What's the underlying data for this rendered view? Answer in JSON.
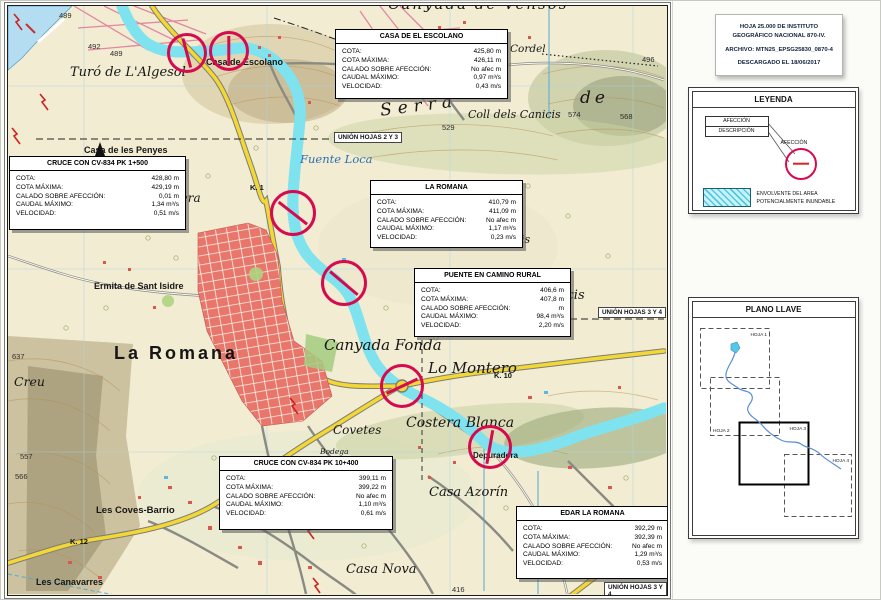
{
  "map": {
    "box_fields": [
      "COTA:",
      "COTA MÁXIMA:",
      "CALADO SOBRE AFECCIÓN:",
      "CAUDAL MÁXIMO:",
      "VELOCIDAD:"
    ],
    "boxes": [
      {
        "title": "CASA DE EL ESCOLANO",
        "values": [
          "425,80 m",
          "426,11 m",
          "No afec m",
          "0,97 m³/s",
          "0,43 m/s"
        ]
      },
      {
        "title": "CRUCE CON CV-834 PK 1+500",
        "values": [
          "428,80 m",
          "429,19 m",
          "0,01 m",
          "1,34 m³/s",
          "0,51 m/s"
        ]
      },
      {
        "title": "LA ROMANA",
        "values": [
          "410,79 m",
          "411,09 m",
          "No afec m",
          "1,17 m³/s",
          "0,23 m/s"
        ]
      },
      {
        "title": "PUENTE EN CAMINO RURAL",
        "values": [
          "406,6 m",
          "407,8 m",
          "m",
          "98,4 m³/s",
          "2,20 m/s"
        ]
      },
      {
        "title": "CRUCE CON CV-834 PK 10+400",
        "values": [
          "399,11 m",
          "399,22 m",
          "No afec m",
          "1,10 m³/s",
          "0,61 m/s"
        ]
      },
      {
        "title": "EDAR LA ROMANA",
        "values": [
          "392,29 m",
          "392,39 m",
          "No afec m",
          "1,29 m³/s",
          "0,53 m/s"
        ]
      }
    ],
    "places": {
      "canyada_vensos": "Canyada de Vensos",
      "turo_algesol": "Turó de L'Algesol",
      "casa_escolano": "Casa de Escolano",
      "a_romana": "a Romana",
      "cordel": "Cordel",
      "serra": "Serra",
      "de": "de",
      "coll_canicis": "Coll  dels  Canicis",
      "fuente_loca": "Fuente Loca",
      "casa_penyes": "Casa de les Penyes",
      "la_teulera": "La Teulera",
      "ermita": "Ermita de Sant  Isidre",
      "la_romana": "La Romana",
      "creu": "Creu",
      "canyada_fonda": "Canyada Fonda",
      "lo_montero": "Lo Montero",
      "costera_blanca": "Costera Blanca",
      "covetes": "Covetes",
      "bodega": "Bodega",
      "casa_azorin": "Casa Azorín",
      "casa_nova": "Casa Nova",
      "les_coves": "Les Coves-Barrio",
      "canavarres": "Les Canavarres",
      "depuradora": "Depuradora",
      "dels_canicis": "dels Canicis",
      "nicis": "nicis"
    },
    "elevations": {
      "a489": "489",
      "a492": "492",
      "b489": "489",
      "a496": "496",
      "a568": "568",
      "a574": "574",
      "a529": "529",
      "a459": "459",
      "a637": "637",
      "a557": "557",
      "a566": "566",
      "a416": "416"
    },
    "km": {
      "k1": "K. 1",
      "k10": "K. 10",
      "k12": "K. 12"
    },
    "unions": {
      "u23": "UNIÓN HOJAS 2 Y 3",
      "u34": "UNIÓN HOJAS 3 Y 4"
    },
    "north": "N"
  },
  "panel": {
    "meta": {
      "line1": "HOJA 25.000 DE INSTITUTO",
      "line2": "GEOGRÁFICO NACIONAL 870-IV.",
      "line3": "ARCHIVO: MTN25_EPSG25830_0870-4",
      "line4": "DESCARGADO EL 18/06/2017"
    },
    "legend": {
      "title": "LEYENDA",
      "callout_row1": "AFECCIÓN",
      "callout_row2": "DESCRIPCIÓN",
      "affection": "AFECCIÓN",
      "envelope1": "ENVOLVENTE DEL AREA",
      "envelope2": "POTENCIALMENTE INUNDABLE"
    },
    "key_plan": {
      "title": "PLANO LLAVE",
      "sheets": [
        "HOJA 1",
        "HOJA 2",
        "HOJA 3",
        "HOJA 4"
      ]
    }
  },
  "colors": {
    "affection_ring": "#d60a4e",
    "flood_cyan": "#7fe3ef",
    "road_yellow": "#f3d735"
  }
}
